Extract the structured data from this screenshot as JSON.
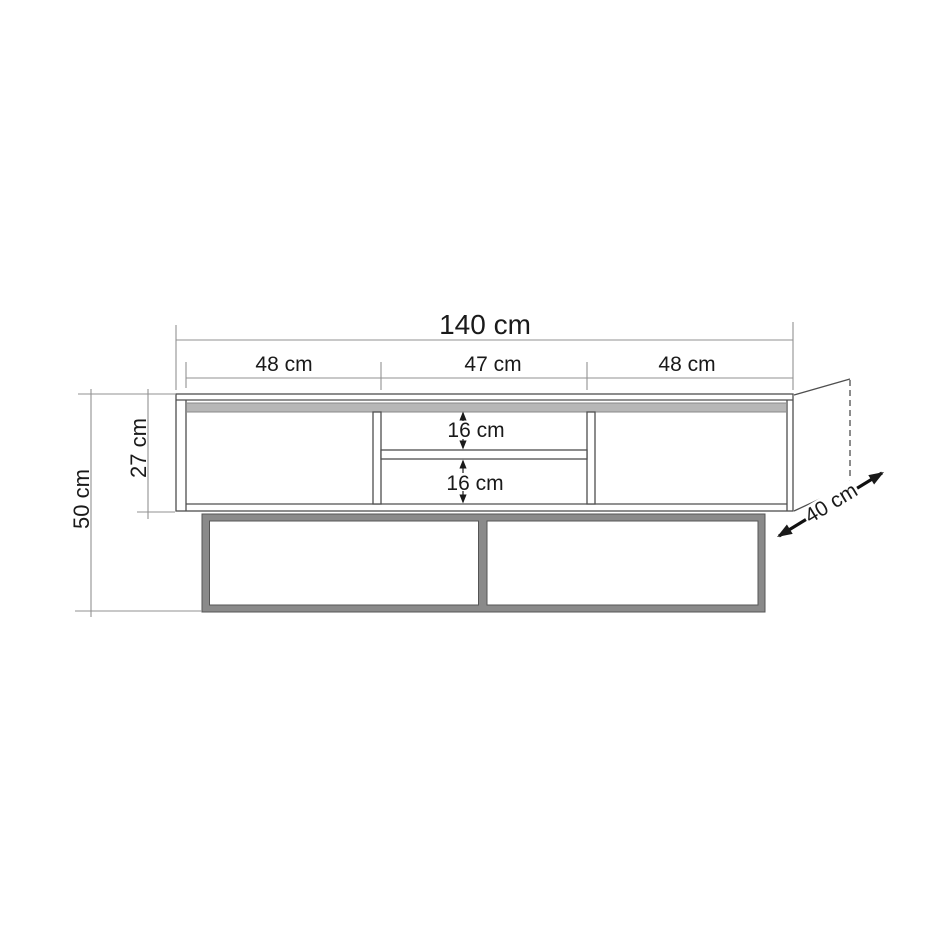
{
  "diagram": {
    "subject": "tv-stand-dimension-drawing",
    "labels": {
      "total_width": "140 cm",
      "section_left": "48 cm",
      "section_middle": "47 cm",
      "section_right": "48 cm",
      "upper_opening": "16 cm",
      "lower_opening": "16 cm",
      "cabinet_height": "27 cm",
      "overall_height": "50 cm",
      "depth": "40 cm"
    },
    "colors": {
      "background": "#ffffff",
      "outline": "#4f4f4f",
      "dimension_line": "#929292",
      "text": "#1a1a1a",
      "top_strip_fill": "#b7b7b7",
      "top_strip_edge": "#8a8a8a",
      "base_frame_fill": "#8a8a8a",
      "base_frame_edge": "#555555"
    }
  }
}
